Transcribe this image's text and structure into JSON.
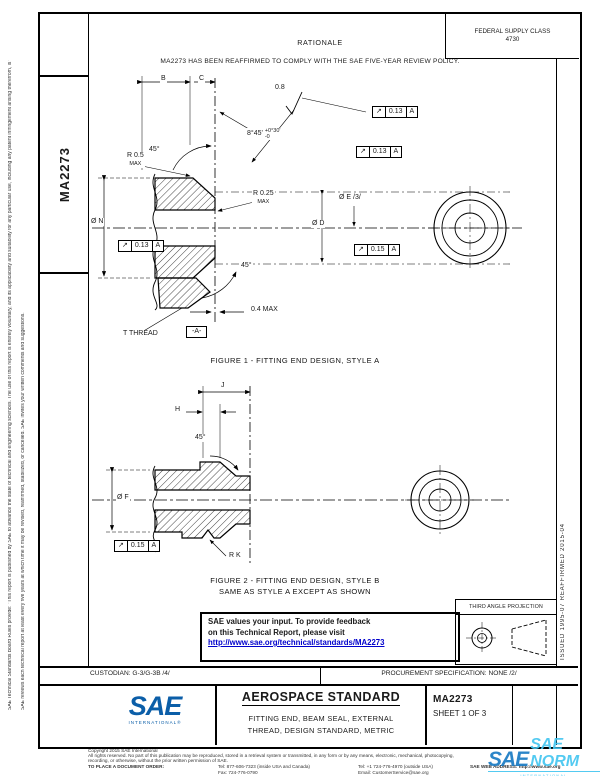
{
  "doc": {
    "number": "MA2273",
    "fsc_label": "FEDERAL SUPPLY CLASS",
    "fsc_code": "4730"
  },
  "margin": {
    "disclaimer1": "SAE Technical Standards Board Rules provide: \"This report is published by SAE to advance the state of technical and engineering sciences. The use of this report is entirely voluntary, and its applicability and suitability for any particular use, including any patent infringement arising therefrom, is the sole responsibility of the user.\"",
    "disclaimer2": "SAE reviews each technical report at least every five years at which time it may be revised, reaffirmed, stabilized, or cancelled. SAE invites your written comments and suggestions.",
    "issued": "ISSUED 1995-07      REAFFIRMED 2015-04"
  },
  "rationale": {
    "heading": "RATIONALE",
    "body": "MA2273 HAS BEEN REAFFIRMED TO COMPLY WITH THE SAE FIVE-YEAR REVIEW POLICY."
  },
  "figure1": {
    "caption": "FIGURE 1 - FITTING END DESIGN, STYLE A",
    "dims": {
      "b": "B",
      "c": "C",
      "finish": "0.8",
      "angle_main": "8°45'",
      "angle_plus": "+0°30'",
      "angle_minus": "-0",
      "r_max": "R 0.5",
      "r_max_suffix": "MAX",
      "angle_top": "45°",
      "dia_n": "Ø N",
      "r_seal": "R 0.25",
      "r_seal_suffix": "MAX",
      "dia_d": "Ø D",
      "dia_e": "Ø E /3/",
      "angle_bottom": "45°",
      "flat": "0.4 MAX",
      "thread": "T THREAD",
      "datum": "-A-"
    },
    "fcfs": [
      {
        "sym": "↗",
        "tol": "0.13",
        "datum": "A"
      },
      {
        "sym": "↗",
        "tol": "0.13",
        "datum": "A"
      },
      {
        "sym": "↗",
        "tol": "0.13",
        "datum": "A"
      },
      {
        "sym": "↗",
        "tol": "0.15",
        "datum": "A"
      }
    ]
  },
  "figure2": {
    "caption1": "FIGURE 2 - FITTING END DESIGN, STYLE B",
    "caption2": "SAME AS STYLE A EXCEPT AS SHOWN",
    "dims": {
      "j": "J",
      "h": "H",
      "angle": "45°",
      "dia_f": "Ø F",
      "r_k": "R K"
    },
    "fcf": {
      "sym": "↗",
      "tol": "0.15",
      "datum": "A"
    }
  },
  "feedback": {
    "line1": "SAE values your input. To provide feedback",
    "line2": "on this Technical Report, please visit",
    "url": "http://www.sae.org/technical/standards/MA2273"
  },
  "projection": {
    "title": "THIRD ANGLE PROJECTION"
  },
  "title_block": {
    "custodian": "CUSTODIAN: G-3/G-3B /4/",
    "procurement": "PROCUREMENT SPECIFICATION: NONE /2/",
    "standard_type": "AEROSPACE STANDARD",
    "title_line1": "FITTING END, BEAM SEAL, EXTERNAL",
    "title_line2": "THREAD, DESIGN STANDARD, METRIC",
    "doc_number": "MA2273",
    "sheet": "SHEET 1 OF 3",
    "logo_text": "SAE",
    "logo_sub": "INTERNATIONAL®"
  },
  "legal": {
    "copyright": "Copyright 2015 SAE International",
    "rights1": "All rights reserved. No part of this publication may be reproduced, stored in a retrieval system or transmitted, in any form or by any means, electronic, mechanical, photocopying,",
    "rights2": "recording, or otherwise, without the prior written permission of SAE.",
    "order_label": "TO PLACE A DOCUMENT ORDER:",
    "tel_inside": "Tel: 877-606-7323 (inside USA and Canada)",
    "tel_outside": "Tel: +1 724-776-4970 (outside USA)",
    "fax": "Fax: 724-776-0790",
    "email": "Email: CustomerService@sae.org",
    "web": "SAE WEB ADDRESS: http://www.sae.org"
  },
  "watermark": {
    "logo": "SAE",
    "text": "SAE NORM",
    "sub": "INTERNATIONAL"
  },
  "colors": {
    "link_blue": "#0000cc",
    "sae_blue": "#0b5ea8",
    "watermark_cyan": "#45c6f0"
  }
}
